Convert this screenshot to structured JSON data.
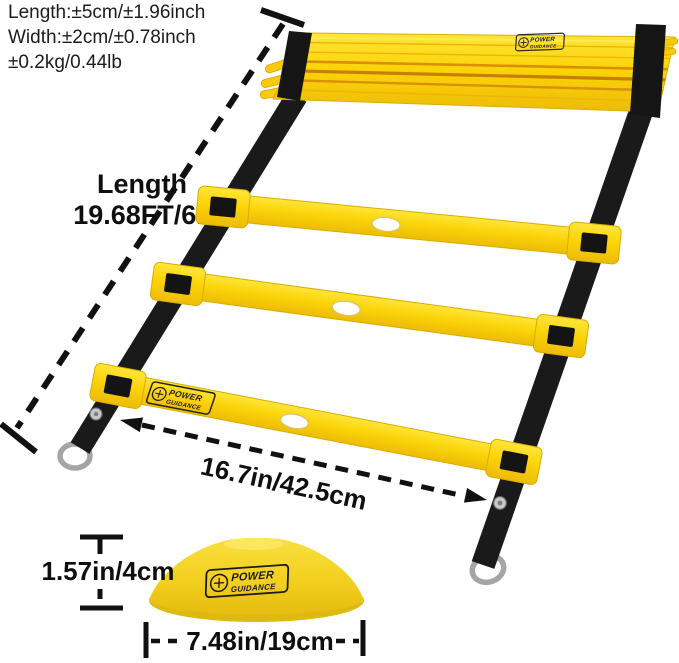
{
  "specs": {
    "line1": "Length:±5cm/±1.96inch",
    "line2": "Width:±2cm/±0.78inch",
    "line3": "±0.2kg/0.44lb"
  },
  "ladder": {
    "length_title": "Length",
    "length_value": "19.68FT/6M",
    "width_label": "16.7in/42.5cm"
  },
  "cone": {
    "height_label": "1.57in/4cm",
    "width_label": "7.48in/19cm"
  },
  "brand": {
    "top": "POWER",
    "bottom": "GUIDANCE"
  },
  "icons": {
    "d_ring": "metal-d-ring",
    "rivet": "metal-snap-rivet",
    "brand_mark": "circled-barbell-cross"
  },
  "colors": {
    "ladder_yellow": "#FBD409",
    "ladder_yellow_dark": "#E8B90A",
    "fold_shadow_orange": "#D98F06",
    "strap_black": "#1A1A1A",
    "metal_gray": "#A5A5A5",
    "text_black": "#111111",
    "background": "#FFFFFF"
  }
}
